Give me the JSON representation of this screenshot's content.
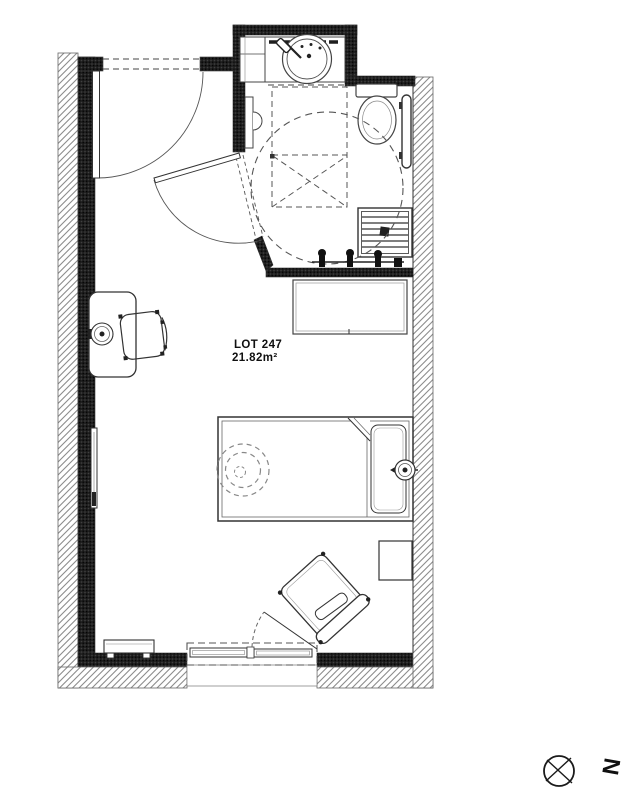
{
  "plan": {
    "lot_label": "LOT 247",
    "area_label": "21.82m²"
  },
  "compass": {
    "letter": "N"
  },
  "colors": {
    "ink": "#333333",
    "wall_fill": "#1c1c1c",
    "hatch_line": "#8c8c8c",
    "dashed_guide": "#555555",
    "background": "#ffffff"
  }
}
